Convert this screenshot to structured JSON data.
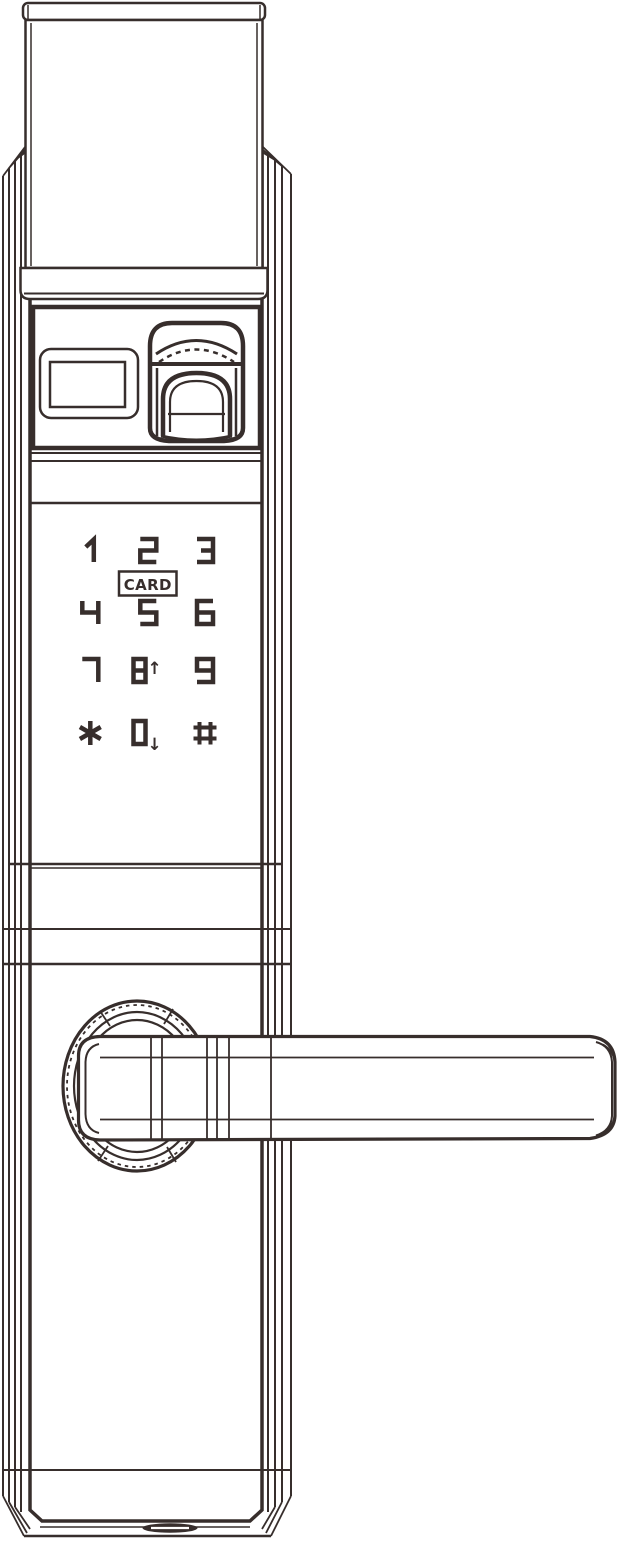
{
  "figure": {
    "subject": "Smart door lock exterior unit - technical line drawing",
    "ink_color": "#372e2c",
    "background_color": "#ffffff"
  },
  "keypad": {
    "rows": [
      [
        "1",
        "2",
        "3"
      ],
      [
        "4",
        "5",
        "6"
      ],
      [
        "7",
        "8",
        "9"
      ],
      [
        "*",
        "0",
        "#"
      ]
    ],
    "card_label": "CARD",
    "up_arrow": "↑",
    "down_arrow": "↓",
    "up_arrow_key": "8",
    "down_arrow_key": "0"
  },
  "components": {
    "top_cover": "top-cover",
    "card_reader_window": "card-reader-window",
    "fingerprint_scanner": "fingerprint-scanner",
    "keypad": "touch-keypad",
    "lever_handle": "lever-handle",
    "rosette": "handle-rosette",
    "bottom_port": "bottom-port"
  }
}
